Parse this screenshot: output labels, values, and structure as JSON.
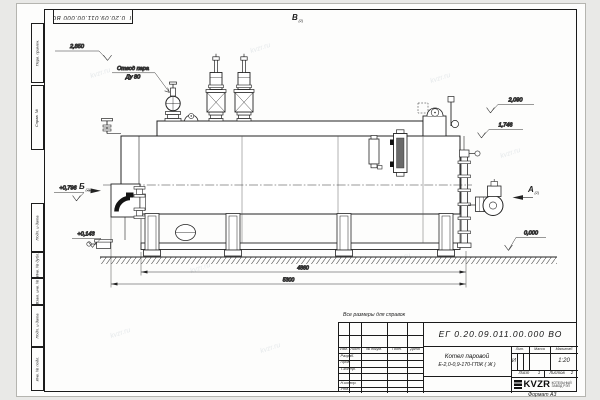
{
  "watermark": {
    "text": "kvzr.ru"
  },
  "frame": {
    "top_stamp": "ЕГ 0.20.09.011.00.000  ВО",
    "format_label": "Формат А3",
    "side_labels": {
      "perv_primen": "Перв. примен.",
      "sprav_no": "Справ. №",
      "podp_data1": "Подп. и дата",
      "inv_dubl": "Инв. № дубл.",
      "vzam_inv": "Взам. инв. №",
      "podp_data2": "Подп. и дата",
      "inv_podl": "Инв. № подл."
    }
  },
  "drawing": {
    "labels": {
      "steam_outlet_1": "Отвод пара",
      "steam_outlet_2": "Ду 80"
    },
    "views": {
      "v": "В",
      "v_ref": "(2)",
      "b": "Б",
      "b_ref": "(2)",
      "a": "А",
      "a_ref": "(2)"
    },
    "elevations": {
      "e2850": "2,850",
      "e2090": "2,090",
      "e1746": "1,746",
      "e0796": "+0,796",
      "e0143": "+0,143",
      "e0000": "0,000"
    },
    "dims": {
      "d4860": "4860",
      "d5300": "5300"
    }
  },
  "title_block": {
    "note": "Все размеры для справок",
    "doc_number": "ЕГ 0.20.09.011.00.000  ВО",
    "product_name_1": "Котел паровой",
    "product_name_2": "Е-2,0-0,9-170-ГПЖ ( Ж )",
    "cols": {
      "izm": "Изм.",
      "list": "Лист",
      "doc": "№ докум.",
      "podp": "Подп.",
      "data": "Дата"
    },
    "rows": {
      "razrab": "Разраб.",
      "prov": "Пров.",
      "tkontr": "Т.контр.",
      "nkontr": "Н.контр.",
      "utv": "Утв."
    },
    "lit": {
      "label": "Лит.",
      "value": "И"
    },
    "massa": {
      "label": "Масса"
    },
    "scale": {
      "label": "Масштаб",
      "value": "1:20"
    },
    "sheet": {
      "label": "Лист",
      "value": "1"
    },
    "sheets": {
      "label": "Листов",
      "value": "2"
    },
    "company": {
      "logo": "KVZR",
      "line1": "КОТЕЛЬНЫЙ",
      "line2": "ЗАВОД РЭП"
    }
  }
}
